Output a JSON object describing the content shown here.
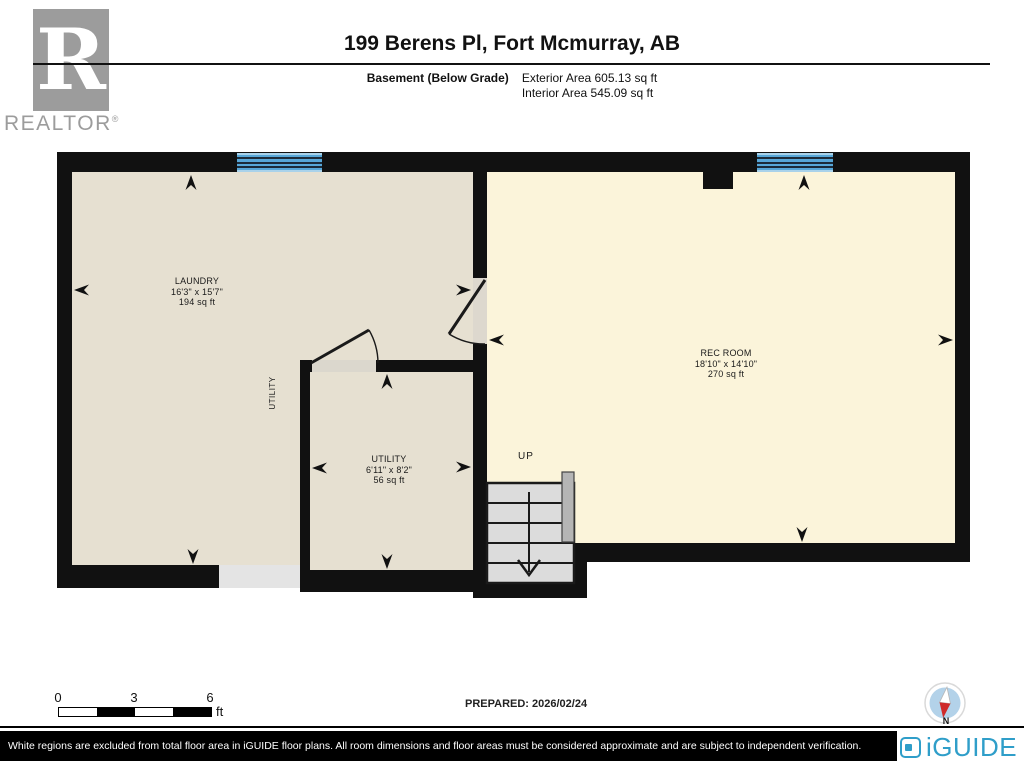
{
  "header": {
    "title": "199 Berens Pl, Fort Mcmurray, AB",
    "floor_label": "Basement (Below Grade)",
    "exterior_area": "Exterior Area 605.13 sq ft",
    "interior_area": "Interior Area 545.09 sq ft",
    "realtor_logo": {
      "letter": "R",
      "word": "REALTOR",
      "reg": "®"
    }
  },
  "rooms": [
    {
      "name": "LAUNDRY",
      "dims": "16'3\" x 15'7\"",
      "area": "194 sq ft"
    },
    {
      "name": "UTILITY",
      "dims": "6'11\" x 8'2\"",
      "area": "56 sq ft"
    },
    {
      "name": "REC ROOM",
      "dims": "18'10\" x 14'10\"",
      "area": "270 sq ft"
    }
  ],
  "labels": {
    "up": "UP",
    "utility_vertical": "UTILITY"
  },
  "scale_bar": {
    "ticks": [
      "0",
      "3",
      "6"
    ],
    "unit": "ft"
  },
  "prepared": "PREPARED: 2026/02/24",
  "compass": {
    "label": "N"
  },
  "footer": {
    "disclaimer": "White regions are excluded from total floor area in iGUIDE floor plans. All room dimensions and floor areas must be considered approximate and are subject to independent verification.",
    "brand": "iGUIDE"
  },
  "colors": {
    "wall": "#111111",
    "laundry_floor": "#e6e0d1",
    "rec_floor": "#fbf4da",
    "window_blue": "#57a7d8",
    "stairs_gray": "#dcdcdc",
    "iguide_blue": "#2f9ec9",
    "compass_needle_red": "#cf2b2b",
    "realtor_gray": "#9c9c9c"
  }
}
